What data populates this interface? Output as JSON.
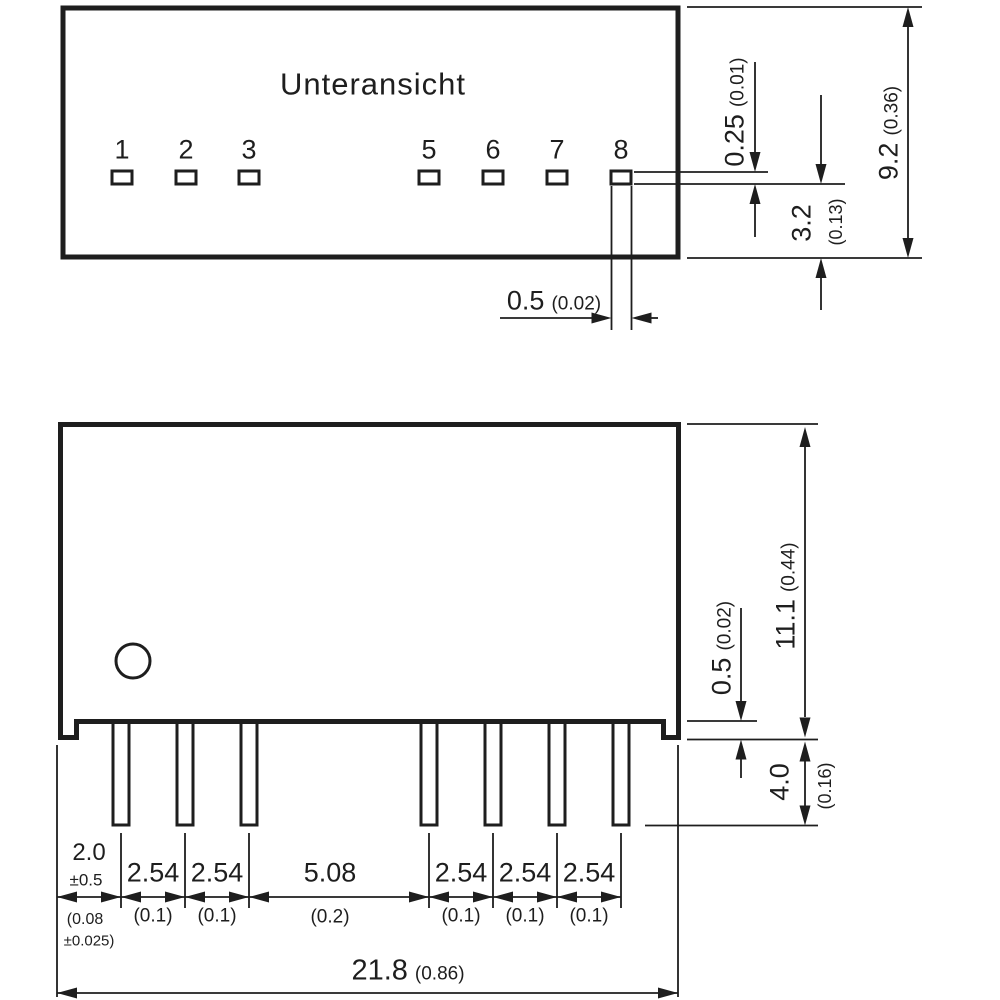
{
  "drawing": {
    "view_label": "Unteransicht",
    "pins": [
      "1",
      "2",
      "3",
      "5",
      "6",
      "7",
      "8"
    ],
    "line_color": "#1e1e1e",
    "dims": {
      "pin_width_mm": "0.5",
      "pin_width_in": "(0.02)",
      "pin_thickness_mm": "0.25",
      "pin_thickness_in": "(0.01)",
      "pin_row_offset_mm": "3.2",
      "pin_row_offset_in": "(0.13)",
      "body_depth_mm": "9.2",
      "body_depth_in": "(0.36)",
      "body_height_mm": "11.1",
      "body_height_in": "(0.44)",
      "standoff_mm": "0.5",
      "standoff_in": "(0.02)",
      "pin_length_mm": "4.0",
      "pin_length_in": "(0.16)",
      "total_width_mm": "21.8",
      "total_width_in": "(0.86)"
    },
    "pitch_chain": [
      {
        "mm": "2.0",
        "tol": "±0.5",
        "in1": "(0.08",
        "in2": "±0.025)"
      },
      {
        "mm": "2.54",
        "in": "(0.1)"
      },
      {
        "mm": "2.54",
        "in": "(0.1)"
      },
      {
        "mm": "5.08",
        "in": "(0.2)"
      },
      {
        "mm": "2.54",
        "in": "(0.1)"
      },
      {
        "mm": "2.54",
        "in": "(0.1)"
      },
      {
        "mm": "2.54",
        "in": "(0.1)"
      }
    ]
  }
}
